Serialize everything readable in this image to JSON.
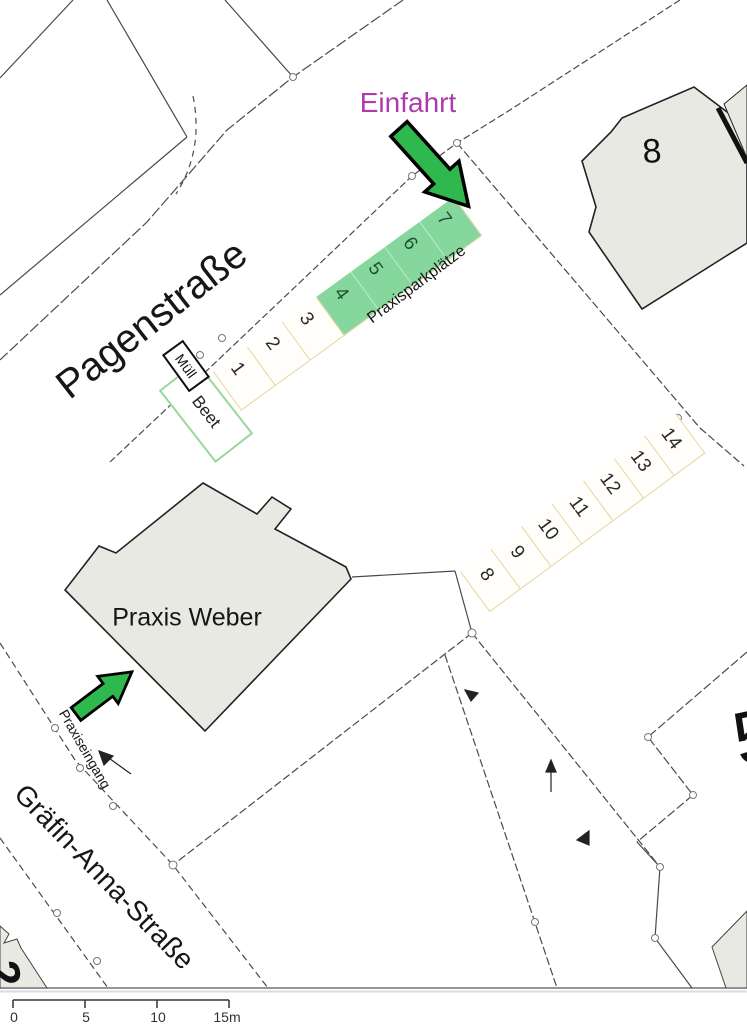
{
  "map": {
    "streets": {
      "pagenstrasse": "Pagenstraße",
      "graefin_anna_strasse": "Gräfin-Anna-Straße"
    },
    "labels": {
      "einfahrt": "Einfahrt",
      "praxisparkplaetze": "Praxisparkplätze",
      "praxis_weber": "Praxis Weber",
      "praxiseingang": "Praxiseingang",
      "muell": "Müll",
      "beet": "Beet",
      "building_number": "8",
      "parcel_number_right": "5",
      "parcel_number_bottom_left": "2"
    },
    "parking": {
      "row_upper": {
        "spots": [
          "1",
          "2",
          "3",
          "4",
          "5",
          "6",
          "7"
        ],
        "green_spots": [
          "4",
          "5",
          "6",
          "7"
        ]
      },
      "row_lower": {
        "spots": [
          "8",
          "9",
          "10",
          "11",
          "12",
          "13",
          "14"
        ]
      }
    },
    "scale_bar": {
      "tick_labels": [
        "0",
        "5",
        "10",
        "15m"
      ]
    },
    "colors": {
      "parking_green": "#86d79d",
      "arrow_green": "#2eb84d",
      "einfahrt_text": "#ad3bad",
      "building_fill": "#e9e9e4",
      "parking_border": "#e3d79f",
      "beet_border": "#96d89c",
      "line_color": "#4a4a4a"
    }
  }
}
